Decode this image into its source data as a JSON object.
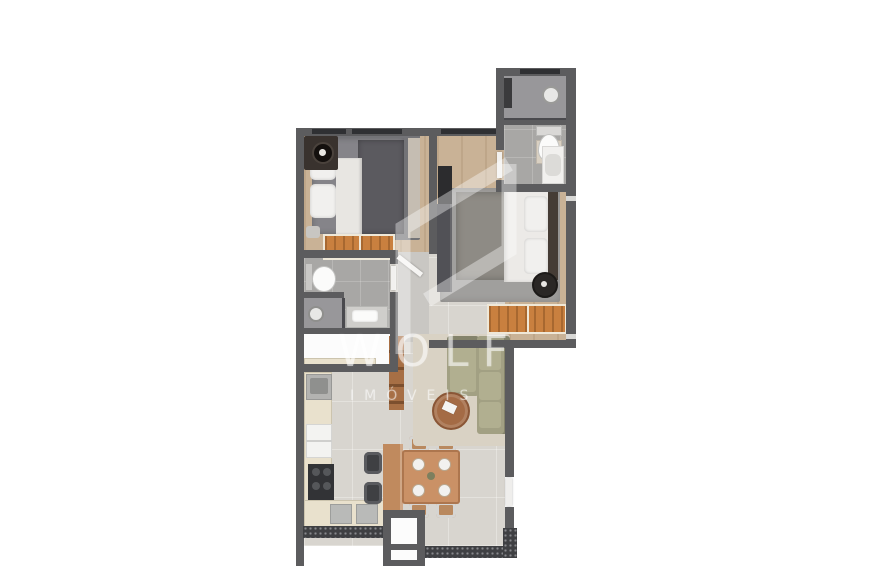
{
  "watermark": {
    "brand": "WOLF",
    "tagline": "IMÓVEIS"
  },
  "palette": {
    "wall": "#5c5c5e",
    "wood": "#c9b296",
    "tile": "#a8a7a5",
    "floor": "#d8d5cf",
    "counter": "#e9e1cd",
    "dresser": "#c9803f",
    "sofa": "#a2a083",
    "sofa_cushion": "#b1af90",
    "rug_bedroom1": "#737377",
    "rug_bedroom2": "#a09f9d",
    "rug_living": "#d9d2c4",
    "table_wood": "#ca9166",
    "appliance_dark": "#323336",
    "watermark_white": "rgba(255,255,255,0.5)"
  },
  "plan": {
    "type": "apartment-floor-plan-top-view",
    "rooms": [
      {
        "name": "bedroom-1",
        "furniture": [
          "double-bed",
          "nightstand-lamp",
          "orange-dresser",
          "rug"
        ]
      },
      {
        "name": "bedroom-2",
        "furniture": [
          "double-bed",
          "wardrobe",
          "orange-dresser",
          "round-pouf",
          "rug"
        ]
      },
      {
        "name": "bathroom-ensuite",
        "furniture": [
          "shower",
          "toilet",
          "vanity-sink"
        ]
      },
      {
        "name": "bathroom-social",
        "furniture": [
          "toilet",
          "shower",
          "vanity-sink"
        ]
      },
      {
        "name": "service-area",
        "furniture": []
      },
      {
        "name": "kitchen",
        "furniture": [
          "sink",
          "fridge",
          "stove",
          "counter",
          "peninsula-bar",
          "bar-stools"
        ]
      },
      {
        "name": "dining-area",
        "furniture": [
          "table-4-seats",
          "plates"
        ]
      },
      {
        "name": "living-room",
        "furniture": [
          "l-shaped-sofa",
          "round-coffee-table",
          "ladder-shelf",
          "rug"
        ]
      },
      {
        "name": "entry",
        "furniture": []
      }
    ]
  }
}
